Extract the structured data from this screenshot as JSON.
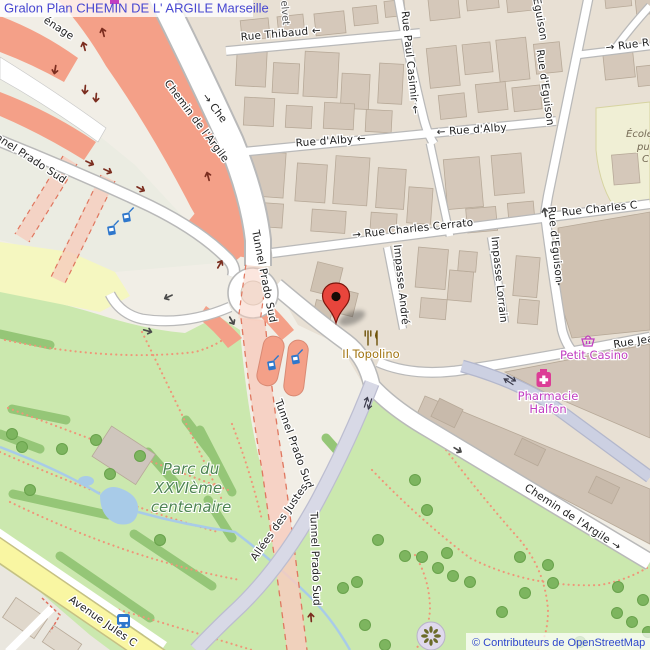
{
  "meta": {
    "title": "Gralon Plan CHEMIN DE L' ARGILE Marseille",
    "attribution": "© Contributeurs de OpenStreetMap"
  },
  "streets": {
    "carenage_fragment": "énage",
    "chemin_argile": "Chemin de l'Argile",
    "che_fragment": "→ Che",
    "chemin_argile_arrow": "Chemin de l'Argile →",
    "thibaud": "Rue Thibaud ←",
    "paul_casimir": "Rue Paul Casimir ←",
    "alby_left": "Rue d'Alby ←",
    "alby_right": "← Rue d'Alby",
    "cerrato": "→ Rue Charles Cerrato",
    "cerrato_fragment": "Rue Charles C",
    "eguison": "Rue d'Eguison",
    "impasse_andre": "Impasse André",
    "impasse_lorrain": "Impasse Lorrain",
    "rue_jean_fragment": "Rue Jea",
    "rue_r_fragment": "→ Rue R",
    "tunnel_prado_sud": "Tunnel Prado Sud",
    "allees_justes": "Allées des Justes",
    "avenue_jules": "Avenue Jules C"
  },
  "places": {
    "park_line1": "Parc du",
    "park_line2": "XXVIème",
    "park_line3": "centenaire",
    "restaurant": "Il Topolino",
    "shop_velvet": "elvet",
    "convenience": "Petit Casino",
    "pharmacy_line1": "Pharmacie",
    "pharmacy_line2": "Halfon",
    "school_line1": "École é",
    "school_line2": "pu",
    "school_line3": "C"
  },
  "colors": {
    "motorway": "#f4a088",
    "tunnel": "#f7cdbe",
    "park_green": "#cbe8ae",
    "poi_magenta": "#c13ec1",
    "poi_amber": "#a0730e",
    "pharmacy_pink": "#dc3d96",
    "icon_blue": "#2e77cc",
    "marker_red": "#e8453c",
    "title_blue": "#4747d1",
    "link_blue": "#2e46cc"
  }
}
